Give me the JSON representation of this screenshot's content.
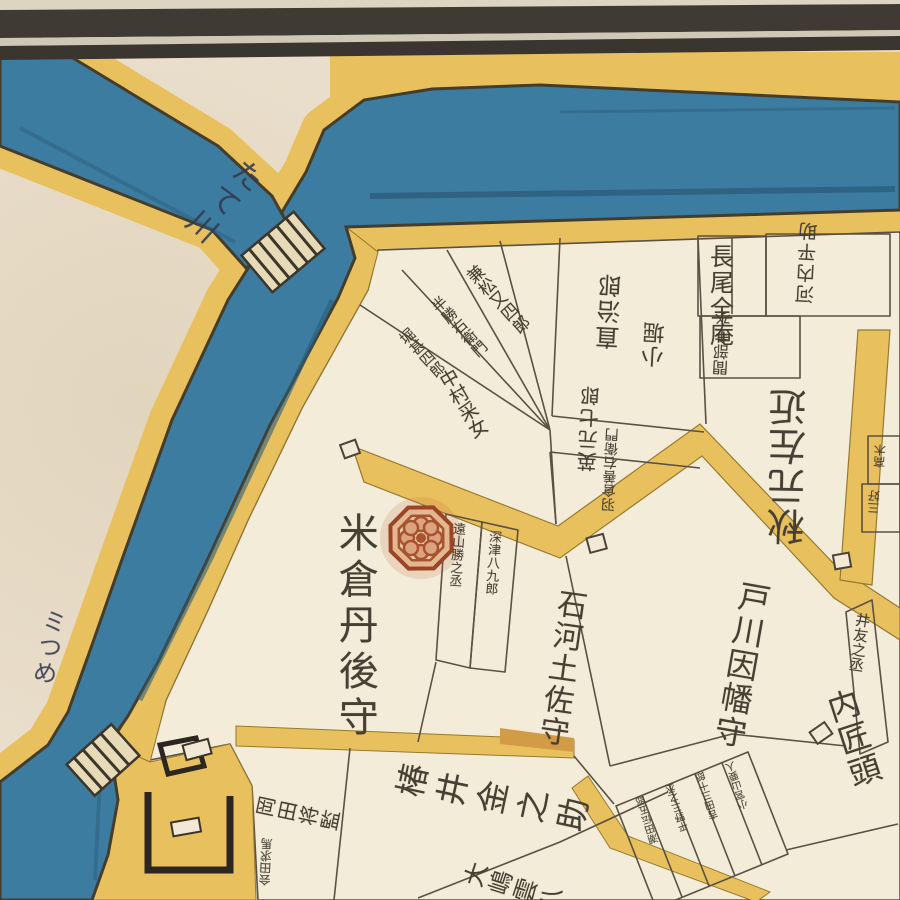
{
  "map": {
    "type": "edo-period-woodblock-district-map",
    "colors": {
      "paper": "#e9decb",
      "plot_fill": "#f3ecd8",
      "water": "#3d7ca1",
      "water_dark": "#2c5d7c",
      "road": "#e9c05e",
      "road_cap": "#d29b45",
      "frame_bar": "#3f3b34",
      "ink": "#473f33",
      "crest_red": "#a8522e"
    },
    "labels": {
      "yonekura": "米倉丹後守",
      "ishiko": "石河土佐守",
      "togawa": "戸川因幡守",
      "tsubai": "椿井金之助",
      "kobori_line1": "直治郎",
      "kobori_line2": "小堀",
      "kanematsu": "兼松又四郎",
      "hankatsu": "半勝右衛門",
      "hori": "堀甚四郎",
      "nakamura": "中村采女",
      "hanamoto": "英元七郎",
      "hagura": "羽倉善右衛門",
      "nagao": "長尾全庵",
      "kawachi": "河内平助",
      "mabe": "間部主水",
      "akimoto": "秋元左近",
      "tooyama": "遠山勝之丞",
      "fukatsu": "深津八九郎",
      "itomo": "井友之丞",
      "takumi": "内匠頭",
      "okada": "岡田将監",
      "aida": "会田求馬",
      "oshima": "大嶋雲八",
      "block1": "潮田伝五郎",
      "block2": "平野三之丞",
      "block3": "吉田三十郎",
      "block4": "小宮山要人",
      "edge1": "高木",
      "edge2": "三好",
      "canal_name": "たて川",
      "bank_note": "ミつめ"
    },
    "features": {
      "bridges": 2,
      "crest": "yonekura-octagon-flower-crest",
      "frame": "double-black-bar-top"
    }
  }
}
